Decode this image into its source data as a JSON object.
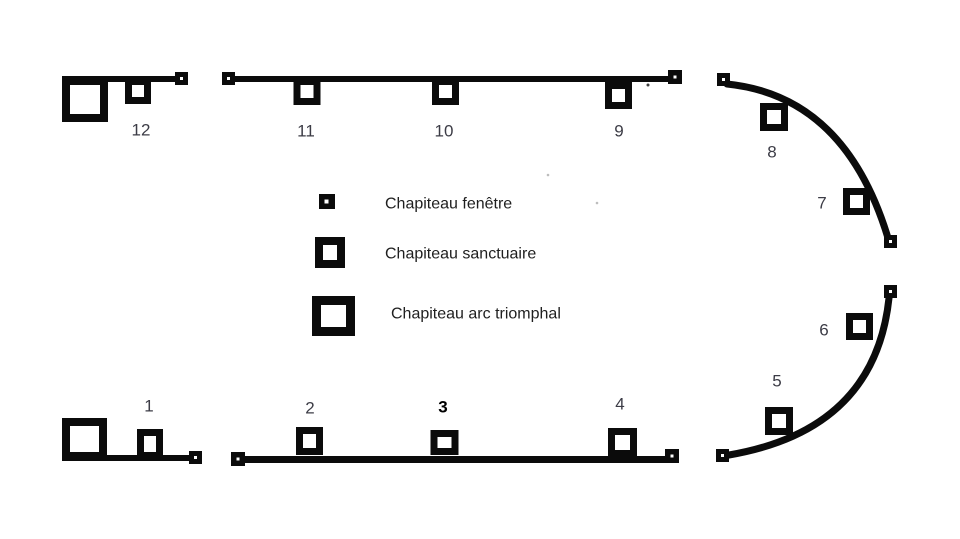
{
  "page": {
    "background": "#ffffff"
  },
  "diagram": {
    "ink_color": "#0b0b0b",
    "number_color": "#3c3c46",
    "numbers": [
      "1",
      "2",
      "3",
      "4",
      "5",
      "6",
      "7",
      "8",
      "9",
      "10",
      "11",
      "12"
    ]
  },
  "legend": {
    "items": [
      {
        "icon": "window-capital-icon",
        "label": "Chapiteau fenêtre"
      },
      {
        "icon": "sanctuary-capital-icon",
        "label": "Chapiteau sanctuaire"
      },
      {
        "icon": "triumphal-arch-capital-icon",
        "label": "Chapiteau arc triomphal"
      }
    ]
  }
}
